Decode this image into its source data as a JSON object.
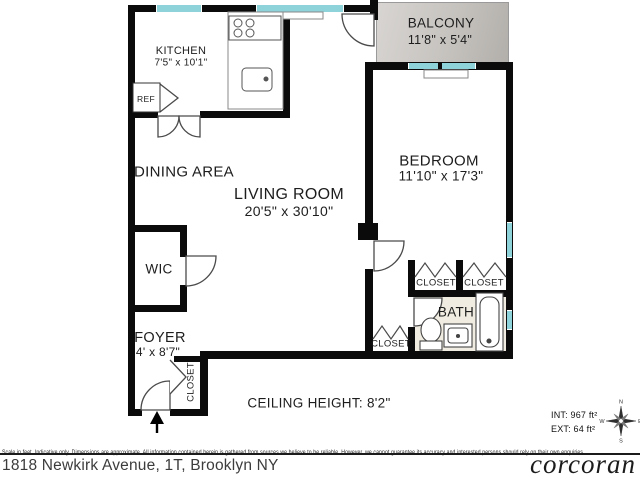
{
  "plan": {
    "kitchen": {
      "label": "KITCHEN",
      "dims": "7'5\" x 10'1\""
    },
    "dining": {
      "label": "DINING AREA"
    },
    "living": {
      "label": "LIVING ROOM",
      "dims": "20'5\" x 30'10\""
    },
    "balcony": {
      "label": "BALCONY",
      "dims": "11'8\" x 5'4\""
    },
    "bedroom": {
      "label": "BEDROOM",
      "dims": "11'10\" x 17'3\""
    },
    "wic": {
      "label": "WIC"
    },
    "foyer": {
      "label": "FOYER",
      "dims": "4' x 8'7\""
    },
    "bath": {
      "label": "BATH"
    },
    "closet_bedroom_left": {
      "label": "CLOSET"
    },
    "closet_bedroom_right": {
      "label": "CLOSET"
    },
    "closet_hall": {
      "label": "CLOSET"
    },
    "closet_foyer": {
      "label": "CLOSET"
    },
    "fridge": {
      "label": "REF"
    },
    "ceiling_note": "CEILING HEIGHT: 8'2\"",
    "int_area": "INT: 967 ft²",
    "ext_area": "EXT: 64 ft²"
  },
  "compass": {
    "n": "N",
    "e": "E",
    "s": "S",
    "w": "W"
  },
  "footer": {
    "disclaimer": "Scale in feet. Indicative only. Dimensions are approximate. All information contained herein is gathered from sources we believe to be reliable. However, we cannot guarantee its accuracy and interested persons should rely on their own enquiries.",
    "address": "1818 Newkirk Avenue, 1T, Brooklyn NY",
    "brand": "corcoran"
  },
  "colors": {
    "wall": "#0b0b0b",
    "window": "#8ed2da",
    "balcony": "#c6c3bf",
    "bath_floor": "#f0ece1"
  }
}
